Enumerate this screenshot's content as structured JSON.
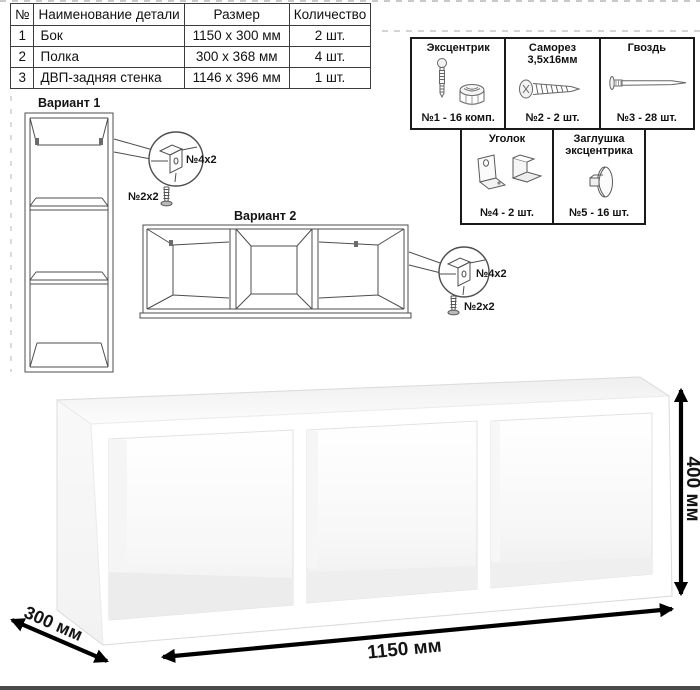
{
  "parts_table": {
    "headers": [
      "№",
      "Наименование детали",
      "Размер",
      "Количество"
    ],
    "rows": [
      {
        "num": "1",
        "name": "Бок",
        "size": "1150 х 300 мм",
        "qty": "2 шт."
      },
      {
        "num": "2",
        "name": "Полка",
        "size": "300 х 368 мм",
        "qty": "4 шт."
      },
      {
        "num": "3",
        "name": "ДВП-задняя стенка",
        "size": "1146 х 396 мм",
        "qty": "1 шт."
      }
    ]
  },
  "hardware_box": {
    "items": [
      {
        "title": "Эксцентрик",
        "subtitle": "",
        "count": "№1 - 16 комп."
      },
      {
        "title": "Саморез",
        "subtitle": "3,5х16мм",
        "count": "№2 - 2 шт."
      },
      {
        "title": "Гвоздь",
        "subtitle": "",
        "count": "№3 - 28 шт."
      },
      {
        "title": "Уголок",
        "subtitle": "",
        "count": "№4 - 2 шт."
      },
      {
        "title": "Заглушка",
        "subtitle": "эксцентрика",
        "count": "№5 - 16 шт."
      }
    ]
  },
  "variants": {
    "variant1": {
      "label": "Вариант 1",
      "bracket_note": "№4х2",
      "screw_note": "№2х2"
    },
    "variant2": {
      "label": "Вариант 2",
      "bracket_note": "№4х2",
      "screw_note": "№2х2"
    }
  },
  "dimensions": {
    "width": "1150 мм",
    "height": "400 мм",
    "depth": "300 мм"
  },
  "colors": {
    "line": "#4d4d4d",
    "arrow": "#000000",
    "table_border": "#3c3c3c",
    "box_border": "#1a1a1a"
  }
}
